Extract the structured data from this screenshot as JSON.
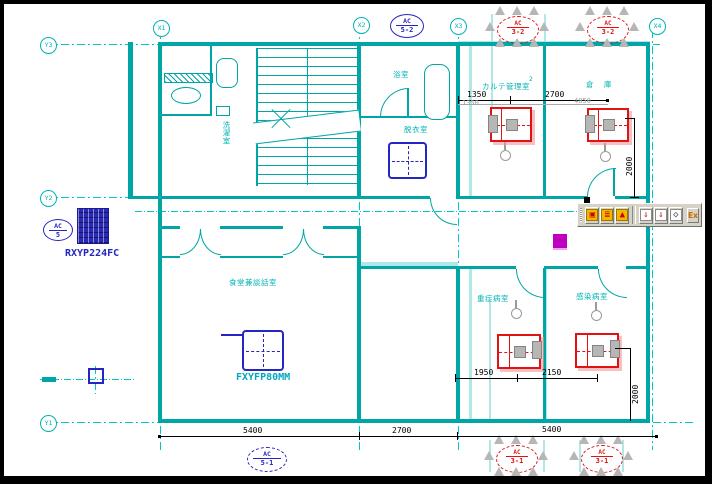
{
  "grid": {
    "y3": "Y3",
    "y2": "Y2",
    "y1": "Y1",
    "x1": "X1",
    "x2": "X2",
    "x3": "X3",
    "x4": "X4"
  },
  "rooms": {
    "laundry": "洗濯室",
    "bath": "浴室",
    "changing": "脱衣室",
    "records": "カルテ管理室",
    "records_note": "2",
    "storage": "倉 庫",
    "dining": "食堂兼談話室",
    "ward_left": "重症病室",
    "ward_right": "感染病室"
  },
  "equipment": {
    "outdoor_label": "RXYP224FC",
    "indoor_label": "FXYFP80MM",
    "tag_top": {
      "l1": "AC",
      "l2": "5-2"
    },
    "tag_left": {
      "l1": "AC",
      "l2": "5"
    },
    "tag_bottom": {
      "l1": "AC",
      "l2": "5-1"
    },
    "tag_red_tl": {
      "l1": "AC",
      "l2": "3-2"
    },
    "tag_red_tr": {
      "l1": "AC",
      "l2": "3-2"
    },
    "tag_red_bl": {
      "l1": "AC",
      "l2": "3-1"
    },
    "tag_red_br": {
      "l1": "AC",
      "l2": "3-1"
    }
  },
  "dimensions": {
    "top_1": "1350",
    "top_2": "2700",
    "gray_1": "1350",
    "gray_2": "4050",
    "v_top": "2000",
    "mid_1": "1950",
    "mid_2": "2150",
    "v_mid": "2000",
    "bottom_1": "5400",
    "bottom_2": "2700",
    "bottom_3": "5400"
  },
  "toolbar": {
    "buttons": [
      {
        "glyph": "▣"
      },
      {
        "glyph": "≣"
      },
      {
        "glyph": "▲"
      },
      {
        "glyph": "⇓"
      },
      {
        "glyph": "⇓"
      },
      {
        "glyph": "◇"
      }
    ],
    "ex_label": "Ex"
  }
}
